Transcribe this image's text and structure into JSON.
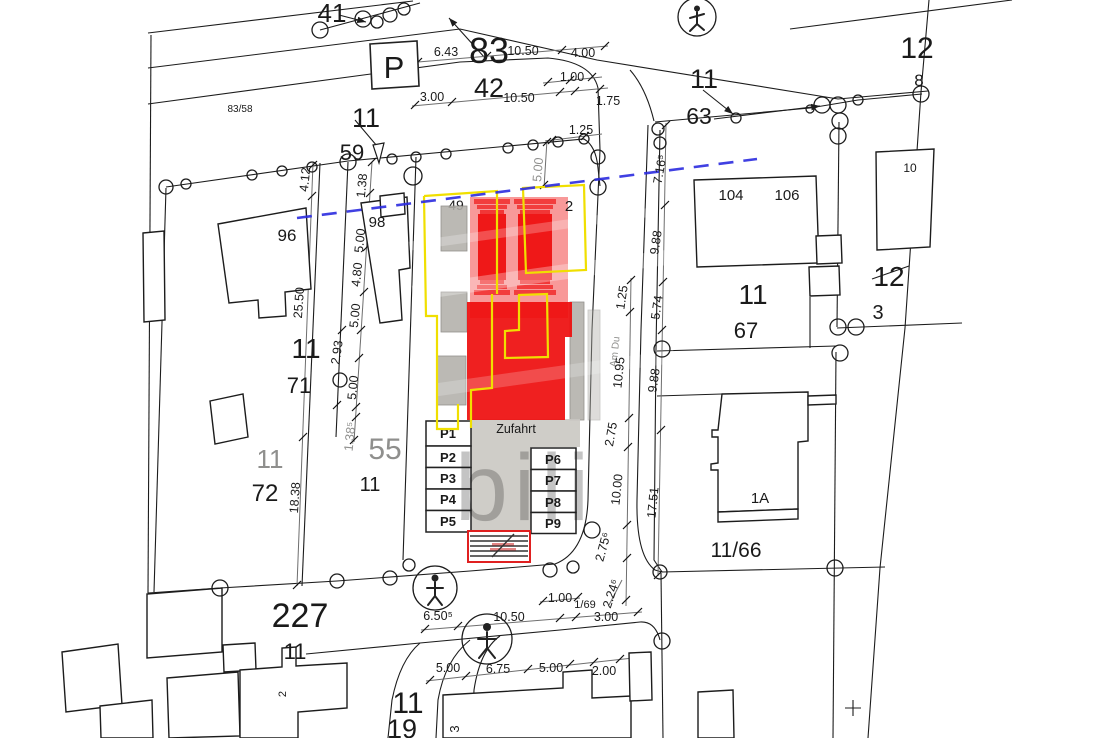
{
  "colors": {
    "line": "#1c1c1c",
    "proposal_red": "#ee0d0d",
    "proposal_pink": "#f79a9a",
    "outline_yellow": "#f0df00",
    "boundary_blue_dashed": "#2b2bdf",
    "existing_gray": "#b2b0aa",
    "driveway_gray": "#cac8c2",
    "crossing_border_red": "#e02020"
  },
  "L": {
    "watermark": "bili",
    "p_sign": "P",
    "street": "Am Du",
    "parcel_41": "41",
    "parcel_83": "83",
    "parcel_42": "42",
    "parcel_83_58": "83/58",
    "parcel_11_top": "11",
    "parcel_59": "59",
    "parcel_12_ne": "12",
    "parcel_8": "8",
    "parcel_10": "10",
    "parcel_11_e": "11",
    "parcel_63": "63",
    "parcel_96": "96",
    "parcel_98": "98",
    "parcel_49": "49",
    "parcel_2_top": "2",
    "parcel_104": "104",
    "parcel_106": "106",
    "parcel_11_67": "11",
    "parcel_67": "67",
    "parcel_12_m": "12",
    "parcel_3_e": "3",
    "parcel_11_w": "11",
    "parcel_71": "71",
    "parcel_11_gray": "11",
    "parcel_72": "72",
    "parcel_55": "55",
    "parcel_11_55": "11",
    "parcel_1a": "1A",
    "parcel_11_66": "11/66",
    "parcel_227": "227",
    "parcel_11_227": "11",
    "parcel_11_s": "11",
    "parcel_19": "19",
    "parcel_3_s": "3",
    "parcel_2_s": "2",
    "parcel_1_69": "1/69"
  },
  "D": {
    "d643": "6.43",
    "d1050a": "10.50",
    "d400": "4.00",
    "d100": "1.00",
    "d300a": "3.00",
    "d1050b": "10.50",
    "d175": "1.75",
    "d125a": "1.25",
    "d500g": "5.00",
    "d412": "4.12",
    "d138a": "1.38",
    "d2550": "25.50",
    "d500a": "5.00",
    "d480": "4.80",
    "d500b": "5.00",
    "d293": "2.93",
    "d500c": "5.00",
    "d138b": "1.38⁵",
    "d1838": "18.38",
    "d716": "7.16⁵",
    "d988n": "9.88",
    "d574": "5.74",
    "d988s": "9.88",
    "d125e": "1.25",
    "d1095": "10.95",
    "d275n": "2.75",
    "d1000": "10.00",
    "d1751": "17.51",
    "d275s": "2.75⁶",
    "d224": "2.24⁶",
    "d100s": "1.00",
    "d650": "6.50⁵",
    "d1050c": "10.50",
    "d300s": "3.00",
    "d500d": "5.00",
    "d675": "6.75",
    "d500e": "5.00",
    "d200": "2.00"
  },
  "PK": {
    "zufahrt": "Zufahrt",
    "stalls": [
      "P1",
      "P2",
      "P3",
      "P4",
      "P5",
      "P6",
      "P7",
      "P8",
      "P9"
    ]
  }
}
